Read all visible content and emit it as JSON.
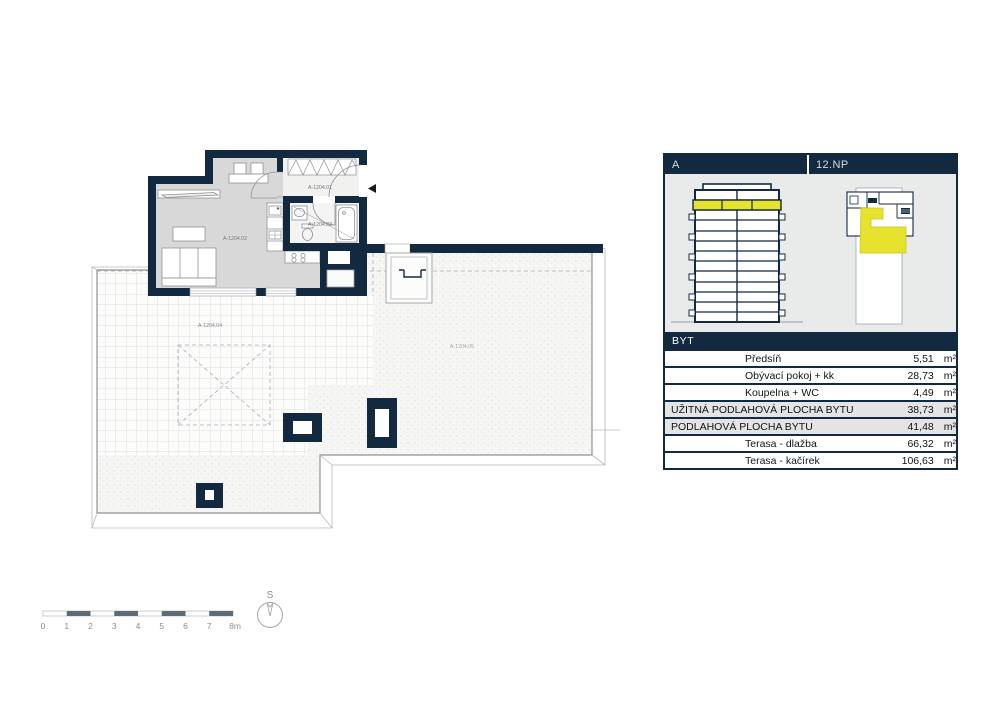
{
  "colors": {
    "navy": "#13293f",
    "yellow": "#e6e32e",
    "sum_bg": "#e4e4e4",
    "floor_gray": "#d8d8d8"
  },
  "plan": {
    "labels": {
      "hall": "A-1204.01",
      "living": "A-1204.02",
      "bath": "A-1204.03",
      "terrace_tiles": "A-1204.04",
      "terrace_gravel": "A-1204.05"
    }
  },
  "panel": {
    "header_left": "A",
    "header_right": "12.NP",
    "table_title": "BYT",
    "rows": [
      {
        "label": "Předsíň",
        "value": "5,51",
        "unit": "m²",
        "emphasis": false
      },
      {
        "label": "Obývací pokoj + kk",
        "value": "28,73",
        "unit": "m²",
        "emphasis": false
      },
      {
        "label": "Koupelna + WC",
        "value": "4,49",
        "unit": "m²",
        "emphasis": false
      },
      {
        "label": "UŽITNÁ PODLAHOVÁ PLOCHA BYTU",
        "value": "38,73",
        "unit": "m²",
        "emphasis": true
      },
      {
        "label": "PODLAHOVÁ PLOCHA BYTU",
        "value": "41,48",
        "unit": "m²",
        "emphasis": true
      },
      {
        "label": "Terasa - dlažba",
        "value": "66,32",
        "unit": "m²",
        "emphasis": false
      },
      {
        "label": "Terasa - kačírek",
        "value": "106,63",
        "unit": "m²",
        "emphasis": false
      }
    ]
  },
  "scalebar": {
    "labels": [
      "0",
      "1",
      "2",
      "3",
      "4",
      "5",
      "6",
      "7",
      "8m"
    ]
  },
  "compass": {
    "label": "S"
  }
}
